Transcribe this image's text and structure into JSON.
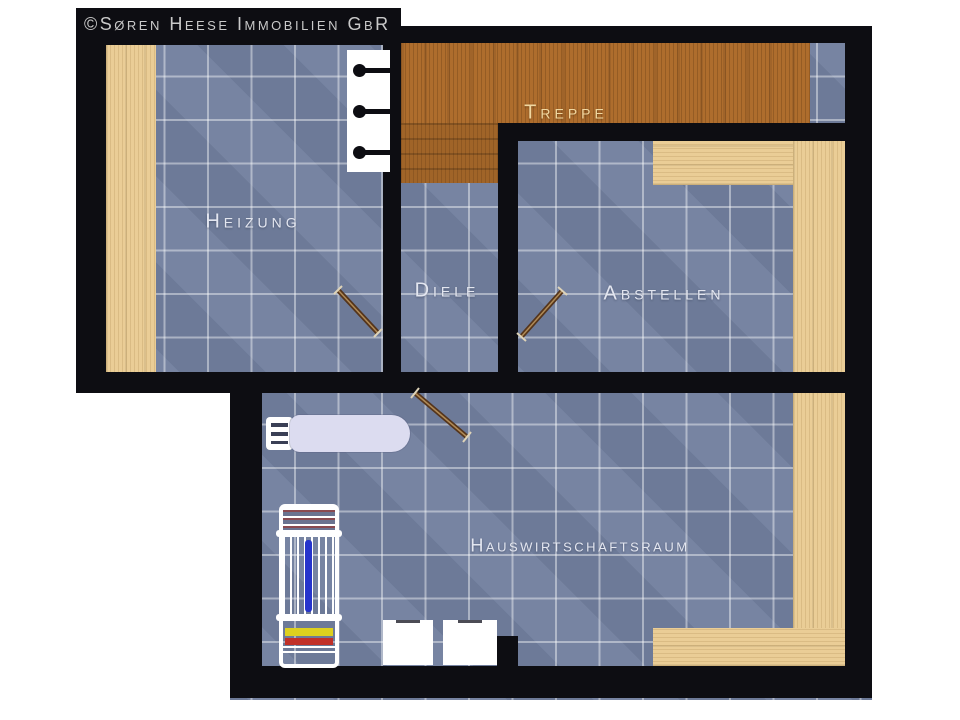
{
  "copyright": "©Søren Heese Immobilien GbR",
  "rooms": {
    "heizung": {
      "label": "Heizung"
    },
    "treppe": {
      "label": "Treppe"
    },
    "diele": {
      "label": "Diele"
    },
    "abstellen": {
      "label": "Abstellen"
    },
    "hauswirtschaftsraum": {
      "label": "Hauswirtschaftsraum"
    }
  },
  "fixtures": [
    "radiator",
    "ironing-board",
    "drying-rack",
    "washer-dryer",
    "door-swing"
  ],
  "colors": {
    "wall": "#0d0d12",
    "tile_floor": "#72809f",
    "tile_grout": "#aeb9d2",
    "wood_dark": "#ae6d2d",
    "wood_light": "#eacd96",
    "room_label_text": "#e3e6f0",
    "treppe_label_text": "#f0d7a0",
    "copyright_text": "#c9c9c9",
    "ironing_board": "#dcdcf0",
    "rack_blue": "#2634cc",
    "rack_yellow": "#ddd01e",
    "rack_red": "#c03028"
  }
}
